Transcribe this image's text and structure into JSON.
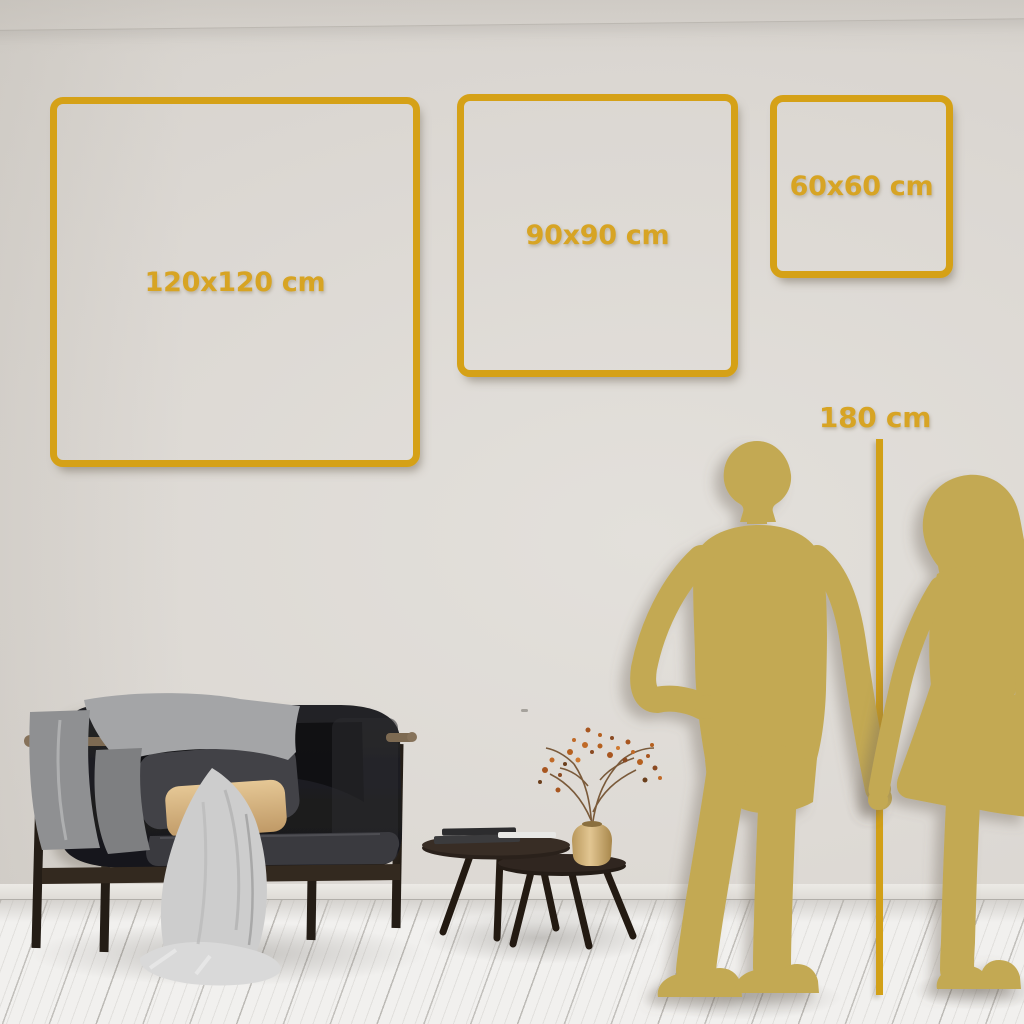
{
  "size_guide": {
    "sizes": [
      {
        "id": "large",
        "label": "120x120 cm"
      },
      {
        "id": "medium",
        "label": "90x90 cm"
      },
      {
        "id": "small",
        "label": "60x60 cm"
      }
    ],
    "reference": {
      "label": "180 cm"
    }
  },
  "palette": {
    "frame_gold": "#d5a117",
    "label_gold": "#d7a424",
    "line_gold": "#d2a017",
    "silhouette_gold": "#c3a953",
    "wall": "#dcd8d3",
    "floor": "#f1f0ee"
  }
}
